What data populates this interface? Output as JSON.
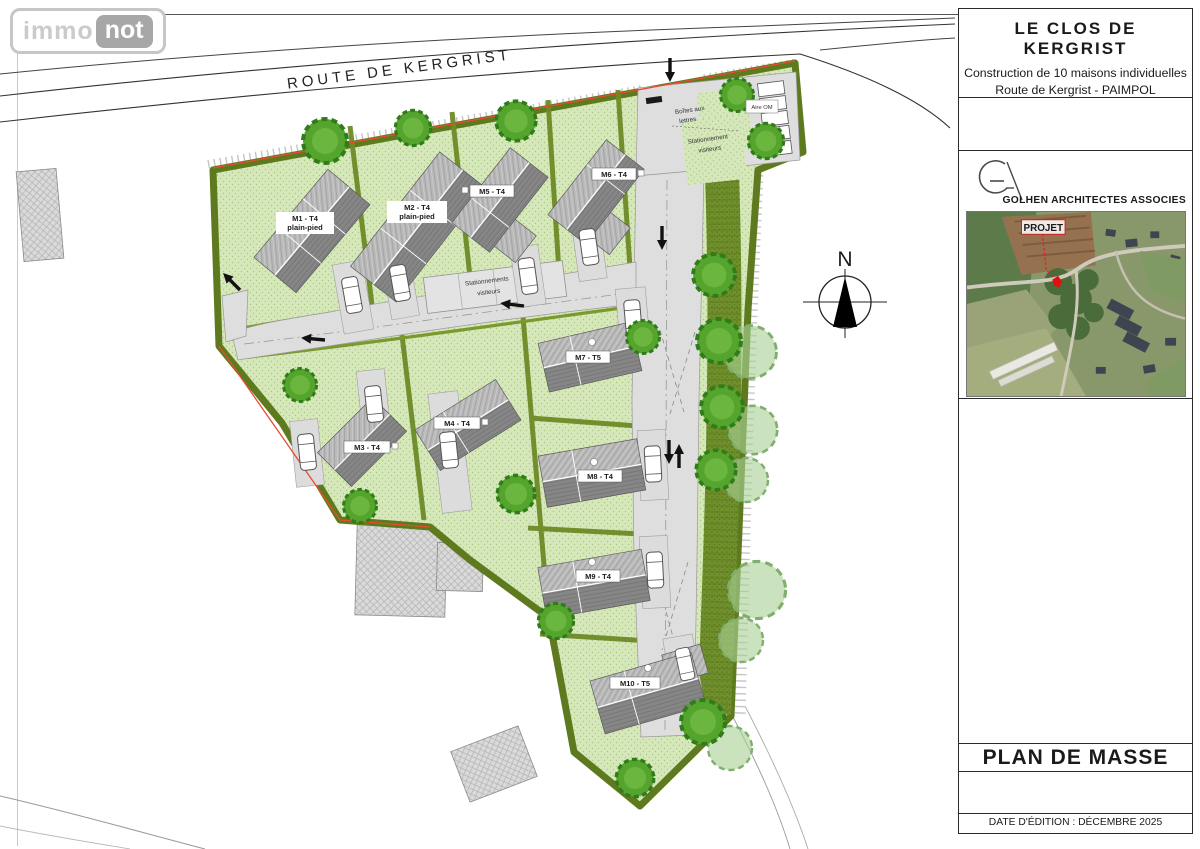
{
  "logo": {
    "immo": "immo",
    "not": "not"
  },
  "sidebar": {
    "title": "LE CLOS DE KERGRIST",
    "subtitle_line1": "Construction de 10 maisons individuelles",
    "subtitle_line2": "Route de Kergrist - PAIMPOL",
    "architect_name": "GOLHEN ARCHITECTES ASSOCIES",
    "aerial_label": "PROJET",
    "plan_title": "PLAN DE MASSE",
    "edition": "DATE D'ÉDITION : DÉCEMBRE 2025"
  },
  "plan": {
    "road_name": "ROUTE DE KERGRIST",
    "north": "N",
    "labels": {
      "mailboxes_l1": "Boîtes aux",
      "mailboxes_l2": "lettres",
      "entrance_parking_l1": "Stationnement",
      "entrance_parking_l2": "visiteurs",
      "central_parking_l1": "Stationnements",
      "central_parking_l2": "visiteurs",
      "waste": "Aire OM"
    },
    "houses": [
      {
        "id": "M1",
        "label": "M1 - T4",
        "sub": "plain-pied"
      },
      {
        "id": "M2",
        "label": "M2 - T4",
        "sub": "plain-pied"
      },
      {
        "id": "M3",
        "label": "M3 - T4",
        "sub": ""
      },
      {
        "id": "M4",
        "label": "M4 - T4",
        "sub": ""
      },
      {
        "id": "M5",
        "label": "M5 - T4",
        "sub": ""
      },
      {
        "id": "M6",
        "label": "M6 - T4",
        "sub": ""
      },
      {
        "id": "M7",
        "label": "M7 - T5",
        "sub": ""
      },
      {
        "id": "M8",
        "label": "M8 - T4",
        "sub": ""
      },
      {
        "id": "M9",
        "label": "M9 - T4",
        "sub": ""
      },
      {
        "id": "M10",
        "label": "M10 - T5",
        "sub": ""
      }
    ],
    "colors": {
      "lawn": "#d6e8bb",
      "hedge": "#6d8a26",
      "road": "#dedede",
      "roof_dark": "#868686",
      "roof_light": "#b9b9b9",
      "tree": "#55a42d",
      "boundary_red": "#e84b2c"
    }
  }
}
